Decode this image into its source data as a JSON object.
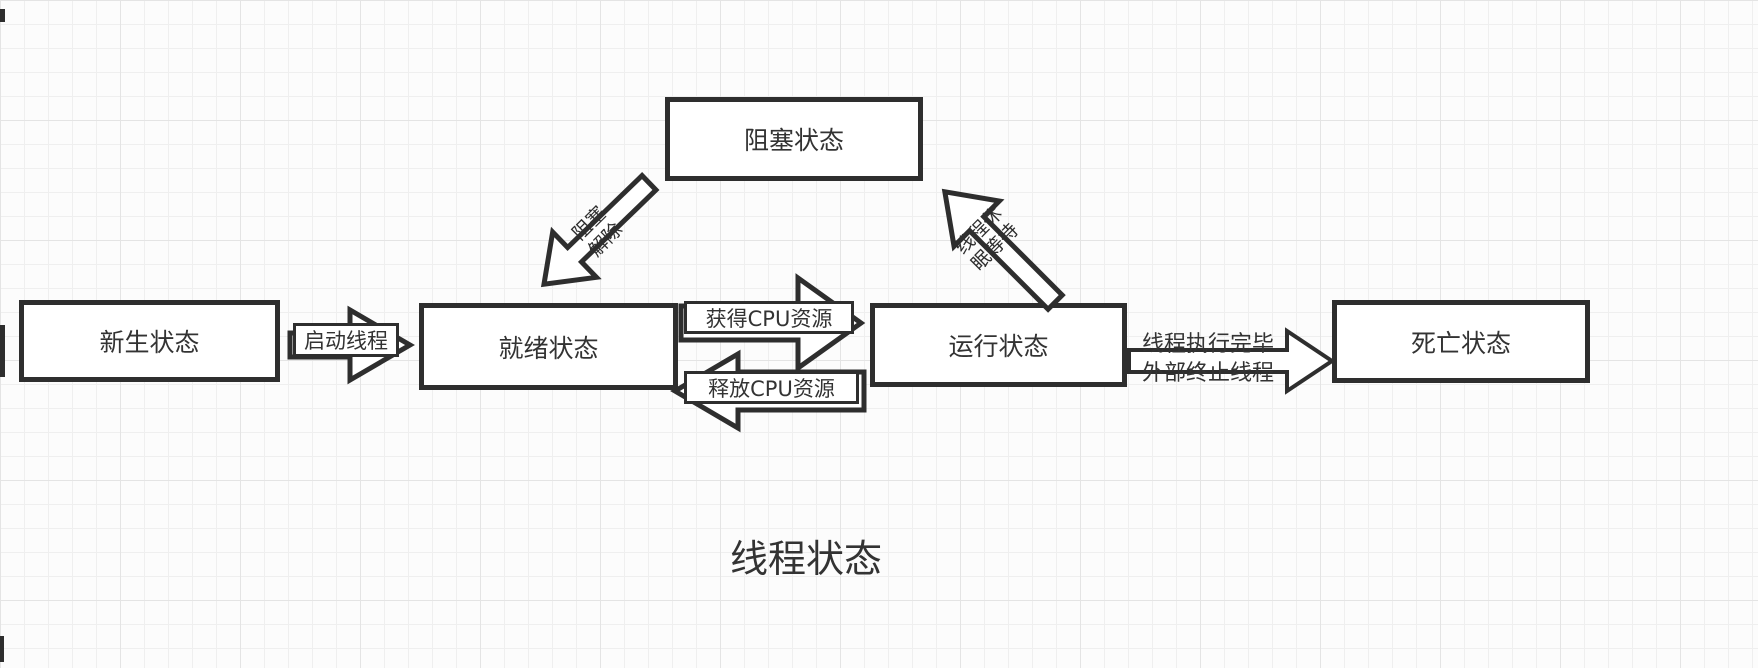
{
  "title": "线程状态",
  "nodes": [
    {
      "id": "new",
      "label": "新生状态"
    },
    {
      "id": "ready",
      "label": "就绪状态"
    },
    {
      "id": "running",
      "label": "运行状态"
    },
    {
      "id": "dead",
      "label": "死亡状态"
    },
    {
      "id": "blocked",
      "label": "阻塞状态"
    }
  ],
  "edges": {
    "start_thread": "启动线程",
    "acquire_cpu": "获得CPU资源",
    "release_cpu": "释放CPU资源",
    "unblock_line1": "阻塞",
    "unblock_line2": "解除",
    "sleep_line1": "线程休",
    "sleep_line2": "眠等待",
    "to_dead_line1": "线程执行完毕",
    "to_dead_line2": "外部终止线程"
  }
}
